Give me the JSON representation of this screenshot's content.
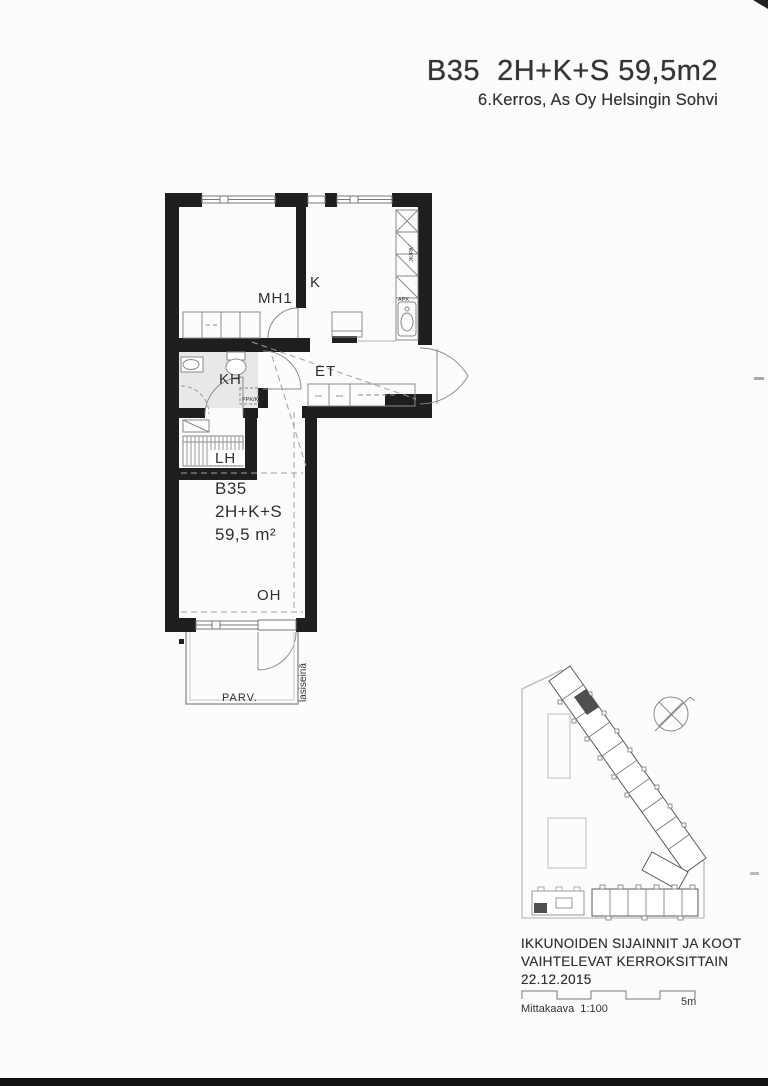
{
  "header": {
    "title": "B35  2H+K+S 59,5m2",
    "subtitle": "6.Kerros, As Oy Helsingin Sohvi"
  },
  "plan": {
    "room_bedroom": "MH1",
    "room_kitchen": "K",
    "room_hall": "ET",
    "room_bath": "KH",
    "room_sauna": "LH",
    "room_living": "OH",
    "room_balcony": "PARV.",
    "apt_id": "B35",
    "apt_type": "2H+K+S",
    "apt_area": "59,5 m²",
    "glass_wall": "lasiseinä",
    "washer": "PPK/KU",
    "dishwasher": "APK",
    "fridge": "JK/PA"
  },
  "footer": {
    "note1": "IKKUNOIDEN SIJAINNIT JA KOOT",
    "note2": "VAIHTELEVAT KERROKSITTAIN",
    "date": "22.12.2015",
    "scale_label": "Mittakaava  1:100",
    "scale_end": "5m"
  },
  "colors": {
    "wall": "#1f1f1f",
    "bath_floor": "#e8e8e8",
    "site_marker": "#4f4f4f"
  }
}
